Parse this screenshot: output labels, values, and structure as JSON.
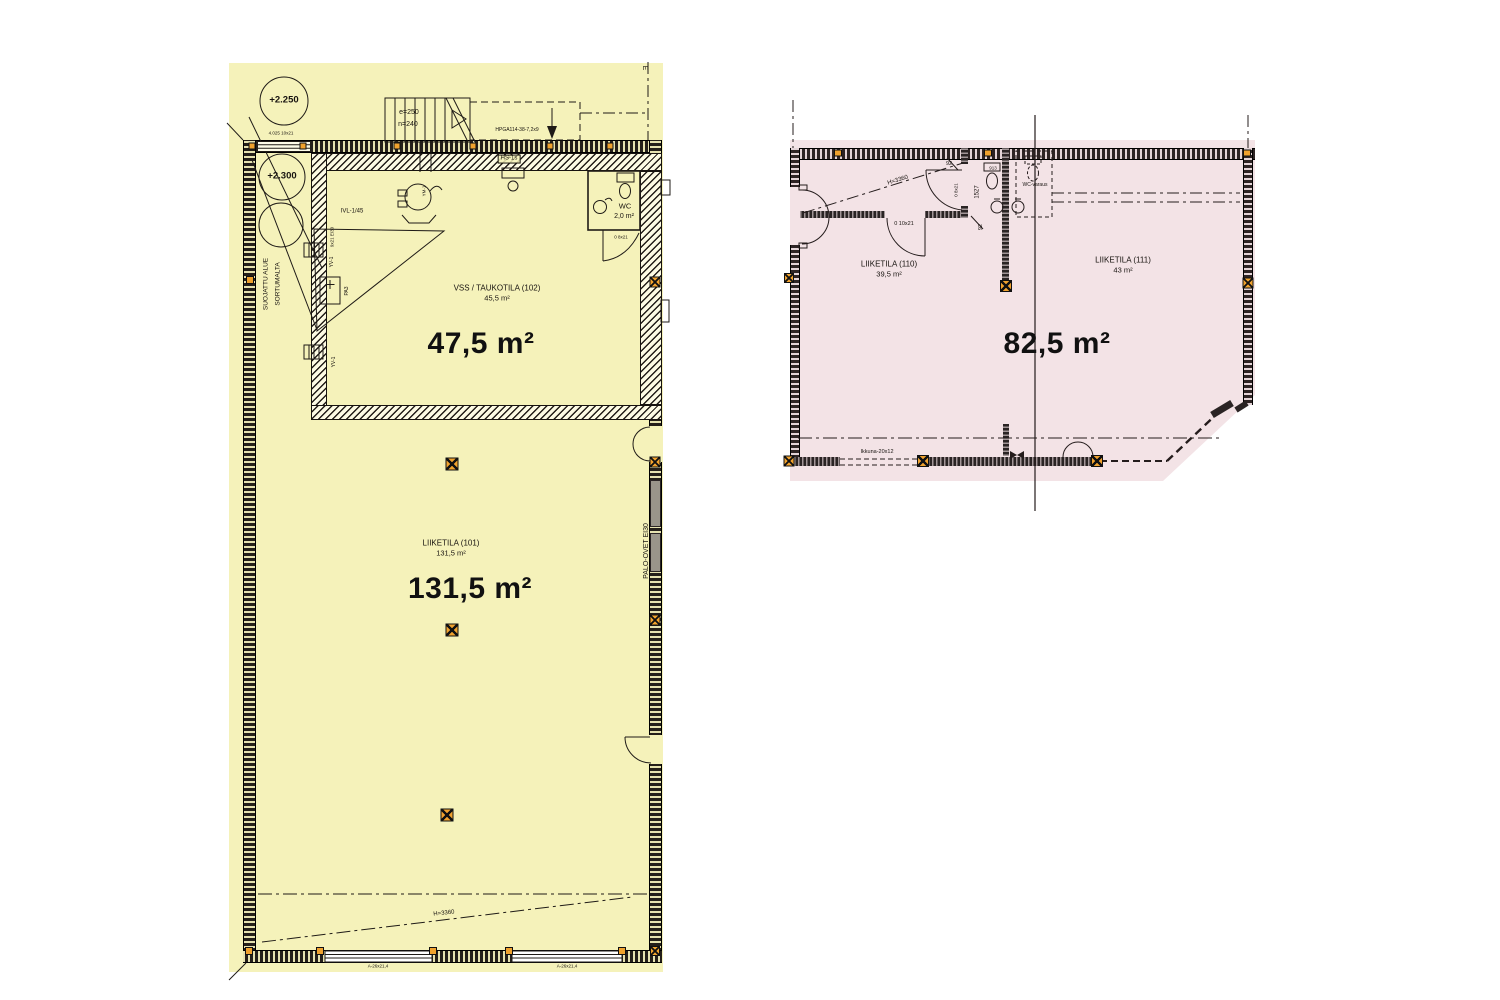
{
  "colors": {
    "left_plan_fill": "#f5f2ba",
    "right_plan_fill": "#f3e3e6",
    "marker_orange": "#f0a22e",
    "line_dark": "#1f1b17"
  },
  "left_plan": {
    "grid_label": "E",
    "level_marker_1": "+2.250",
    "level_marker_2": "+2.300",
    "opening_label": "4.025 10x21",
    "stair_e": "e=250",
    "stair_n": "n=240",
    "beam_label": "HPGA114-38-7,2x9",
    "hs_label": "HS-1s",
    "ym_label": "YM-1",
    "ivl_label": "IVL-1/45",
    "door_ei30_label": "9x21 EI30",
    "yv_label_upper": "YV-1",
    "yv_label_lower": "YV-1",
    "pa_label": "PA3",
    "vss_title": "VSS / TAUKOTILA (102)",
    "vss_area": "45,5 m²",
    "vss_area_big": "47,5 m²",
    "wc_title": "WC",
    "wc_area": "2,0 m²",
    "wc_door_label": "0 8x21",
    "liike_title": "LIIKETILA (101)",
    "liike_area": "131,5 m²",
    "liike_area_big": "131,5 m²",
    "palo_ovet_label": "PALO-OVET EI30",
    "protected_area_line1": "SUOJATTU ALUE",
    "protected_area_line2": "SORTUMALTA",
    "height_label": "H=3360",
    "window_label_left": "A-26x21,4",
    "window_label_right": "A-26x21,4"
  },
  "right_plan": {
    "height_label": "H=3360",
    "dim_top": "92",
    "dim_mid": "1527",
    "dim_bottom": "92",
    "fixture_label": "913",
    "door_left_label": "0 8x21",
    "door_bottom_label": "0 10x21",
    "wc_reservation_label": "WC-varaus",
    "liike110_title": "LIIKETILA (110)",
    "liike110_area": "39,5 m²",
    "liike111_title": "LIIKETILA (111)",
    "liike111_area": "43 m²",
    "area_big": "82,5 m²",
    "window_label": "Ikkuna-20x12"
  }
}
